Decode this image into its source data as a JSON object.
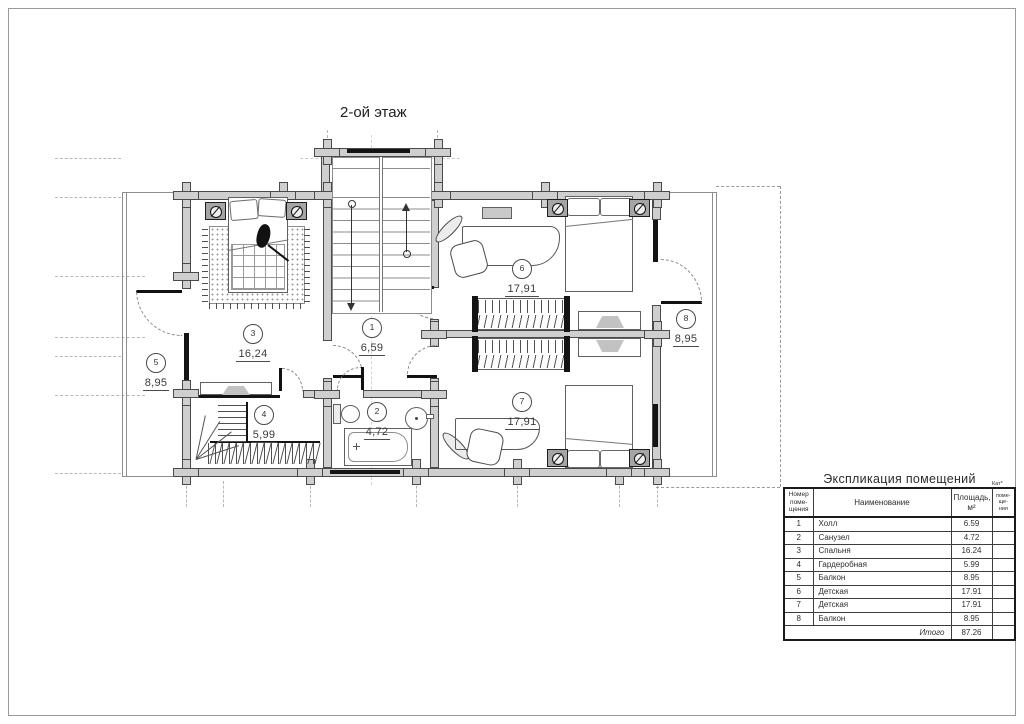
{
  "title": "2-ой этаж",
  "plan": {
    "rooms": [
      {
        "num": "1",
        "area": "6,59"
      },
      {
        "num": "2",
        "area": "4,72"
      },
      {
        "num": "3",
        "area": "16,24"
      },
      {
        "num": "4",
        "area": "5,99"
      },
      {
        "num": "5",
        "area": "8,95"
      },
      {
        "num": "6",
        "area": "17,91"
      },
      {
        "num": "7",
        "area": "17,91"
      },
      {
        "num": "8",
        "area": "8,95"
      }
    ]
  },
  "table": {
    "title": "Экспликация помещений",
    "col_num": "Номер\nпоме-\nщения",
    "col_name": "Наименование",
    "col_area": "Площадь,\nм²",
    "col_cat_top": "Кат*",
    "col_cat": "поме-\nще-\nния",
    "rows": [
      {
        "num": "1",
        "name": "Холл",
        "area": "6.59"
      },
      {
        "num": "2",
        "name": "Санузел",
        "area": "4.72"
      },
      {
        "num": "3",
        "name": "Спальня",
        "area": "16.24"
      },
      {
        "num": "4",
        "name": "Гардеробная",
        "area": "5.99"
      },
      {
        "num": "5",
        "name": "Балкон",
        "area": "8.95"
      },
      {
        "num": "6",
        "name": "Детская",
        "area": "17.91"
      },
      {
        "num": "7",
        "name": "Детская",
        "area": "17.91"
      },
      {
        "num": "8",
        "name": "Балкон",
        "area": "8.95"
      }
    ],
    "total_label": "Итого",
    "total_value": "87.26"
  }
}
